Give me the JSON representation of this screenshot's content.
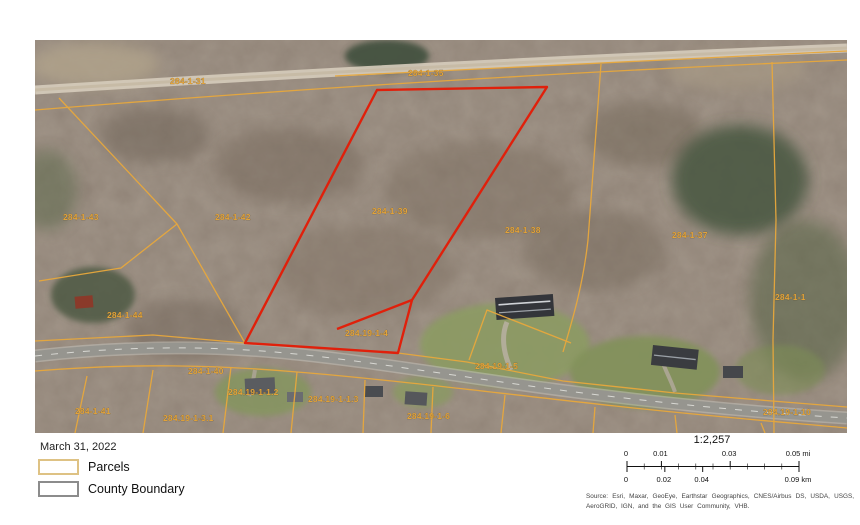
{
  "map": {
    "label_color": "#E2A33B",
    "parcel_line_color": "#E8A83C",
    "selected_parcel_color": "#E0200B",
    "parcel_labels": [
      {
        "text": "284-1-31",
        "x": 135,
        "y": 44
      },
      {
        "text": "284-1-35",
        "x": 373,
        "y": 36
      },
      {
        "text": "284-1-43",
        "x": 28,
        "y": 180
      },
      {
        "text": "284-1-42",
        "x": 180,
        "y": 180
      },
      {
        "text": "284-1-39",
        "x": 337,
        "y": 174
      },
      {
        "text": "284-1-38",
        "x": 470,
        "y": 193
      },
      {
        "text": "284-1-37",
        "x": 637,
        "y": 198
      },
      {
        "text": "284-1-1",
        "x": 740,
        "y": 260
      },
      {
        "text": "284-1-44",
        "x": 72,
        "y": 278
      },
      {
        "text": "284.19-1-4",
        "x": 310,
        "y": 296
      },
      {
        "text": "284.19-1-5",
        "x": 440,
        "y": 329
      },
      {
        "text": "284-1-40",
        "x": 153,
        "y": 334
      },
      {
        "text": "284-1-41",
        "x": 40,
        "y": 374
      },
      {
        "text": "284.19-1-1.2",
        "x": 193,
        "y": 355
      },
      {
        "text": "284.19-1-1.3",
        "x": 273,
        "y": 362
      },
      {
        "text": "284.19-1-3.1",
        "x": 128,
        "y": 381
      },
      {
        "text": "284.19-1-6",
        "x": 372,
        "y": 379
      },
      {
        "text": "284.19-1-10",
        "x": 728,
        "y": 375
      }
    ]
  },
  "legend": {
    "date": "March 31, 2022",
    "items": [
      {
        "label": "Parcels",
        "swatch_color": "#DEC284"
      },
      {
        "label": "County Boundary",
        "swatch_color": "#8C8C8C"
      }
    ]
  },
  "scalebar": {
    "ratio": "1:2,257",
    "miles": {
      "unit": "mi",
      "ticks": [
        {
          "label": "0",
          "pos": 0
        },
        {
          "label": "0.01",
          "pos": 20
        },
        {
          "label": "0.03",
          "pos": 60
        },
        {
          "label": "0.05 mi",
          "pos": 100
        }
      ]
    },
    "km": {
      "unit": "km",
      "ticks": [
        {
          "label": "0",
          "pos": 0
        },
        {
          "label": "0.02",
          "pos": 22
        },
        {
          "label": "0.04",
          "pos": 44
        },
        {
          "label": "0.09 km",
          "pos": 100
        }
      ]
    }
  },
  "attribution": {
    "line1": "Source: Esri, Maxar, GeoEye, Earthstar Geographics, CNES/Airbus DS,",
    "line2": "USDA, USGS, AeroGRID, IGN, and the GIS User Community, VHB."
  }
}
